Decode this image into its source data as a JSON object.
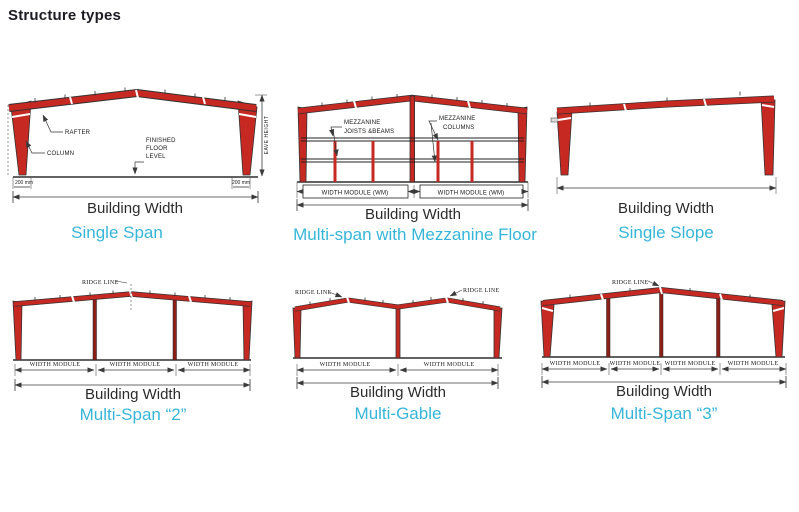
{
  "title": "Structure types",
  "colors": {
    "frame_red": "#c62822",
    "inner_column_red": "#8c1f17",
    "caption_cyan": "#35b6d8",
    "ink": "#161616"
  },
  "diagrams": [
    {
      "id": "single-span",
      "caption": "Single Span",
      "building_width": "Building Width",
      "labels": {
        "rafter": "RAFTER",
        "column": "COLUMN",
        "floor1": "FINISHED",
        "floor2": "FLOOR",
        "floor3": "LEVEL",
        "offset_left": "200 mm",
        "offset_right": "200 mm",
        "eave_height": "EAVE HEIGHT"
      }
    },
    {
      "id": "multi-span-mezzanine",
      "caption": "Multi-span with Mezzanine Floor",
      "building_width": "Building Width",
      "labels": {
        "mezz1": "MEZZANINE",
        "mezz2": "JOISTS &BEAMS",
        "mezz3": "MEZZANINE",
        "mezz4": "COLUMNS",
        "wm_left": "WIDTH MODULE (WM)",
        "wm_right": "WIDTH MODULE (WM)"
      }
    },
    {
      "id": "single-slope",
      "caption": "Single Slope",
      "building_width": "Building Width"
    },
    {
      "id": "multi-span-2",
      "caption": "Multi-Span “2”",
      "building_width": "Building Width",
      "labels": {
        "ridge": "RIDGE LINE",
        "wm": [
          "WIDTH MODULE",
          "WIDTH MODULE",
          "WIDTH MODULE"
        ]
      }
    },
    {
      "id": "multi-gable",
      "caption": "Multi-Gable",
      "building_width": "Building Width",
      "labels": {
        "ridge_left": "RIDGE LINE",
        "ridge_right": "RIDGE LINE",
        "wm": [
          "WIDTH MODULE",
          "WIDTH MODULE"
        ]
      }
    },
    {
      "id": "multi-span-3",
      "caption": "Multi-Span “3”",
      "building_width": "Building Width",
      "labels": {
        "ridge": "RIDGE LINE",
        "wm": [
          "WIDTH MODULE",
          "WIDTH MODULE",
          "WIDTH MODULE",
          "WIDTH MODULE"
        ]
      }
    }
  ]
}
